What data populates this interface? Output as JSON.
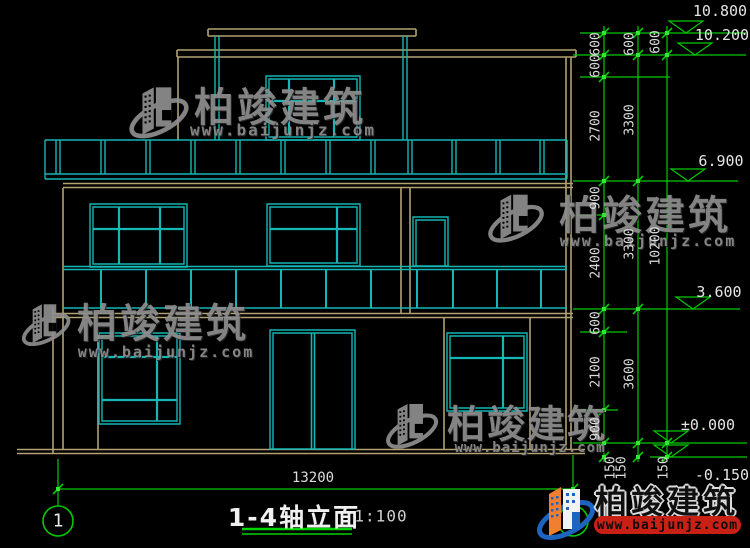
{
  "watermarks": {
    "brand": "柏竣建筑",
    "url": "www.baijunjz.com"
  },
  "footer_logo": {
    "brand": "柏竣建筑",
    "url": "www.baijunjz.com"
  },
  "title_block": {
    "title": "1-4轴立面",
    "scale": "1:100",
    "axis_label": "1",
    "overall_width": "13200"
  },
  "elevation_marks": [
    "10.800",
    "10.200",
    "6.900",
    "3.600",
    "±0.000",
    "-0.150"
  ],
  "dim_chain_inner": [
    "600",
    "600",
    "2700",
    "900",
    "2400",
    "600",
    "2100",
    "900",
    "150"
  ],
  "dim_chain_floor": [
    "600",
    "3300",
    "3300",
    "3600",
    "150"
  ],
  "dim_chain_total": [
    "600",
    "10200",
    "150"
  ],
  "colors": {
    "outline_cyan": "#14b6b6",
    "outline_tan": "#b2a273",
    "dimension_green": "#00ca00",
    "grip_green": "#32e632",
    "underline_green": "#00d400",
    "footer_red": "#c92015",
    "watermark_gray": "#8f8f8f"
  }
}
